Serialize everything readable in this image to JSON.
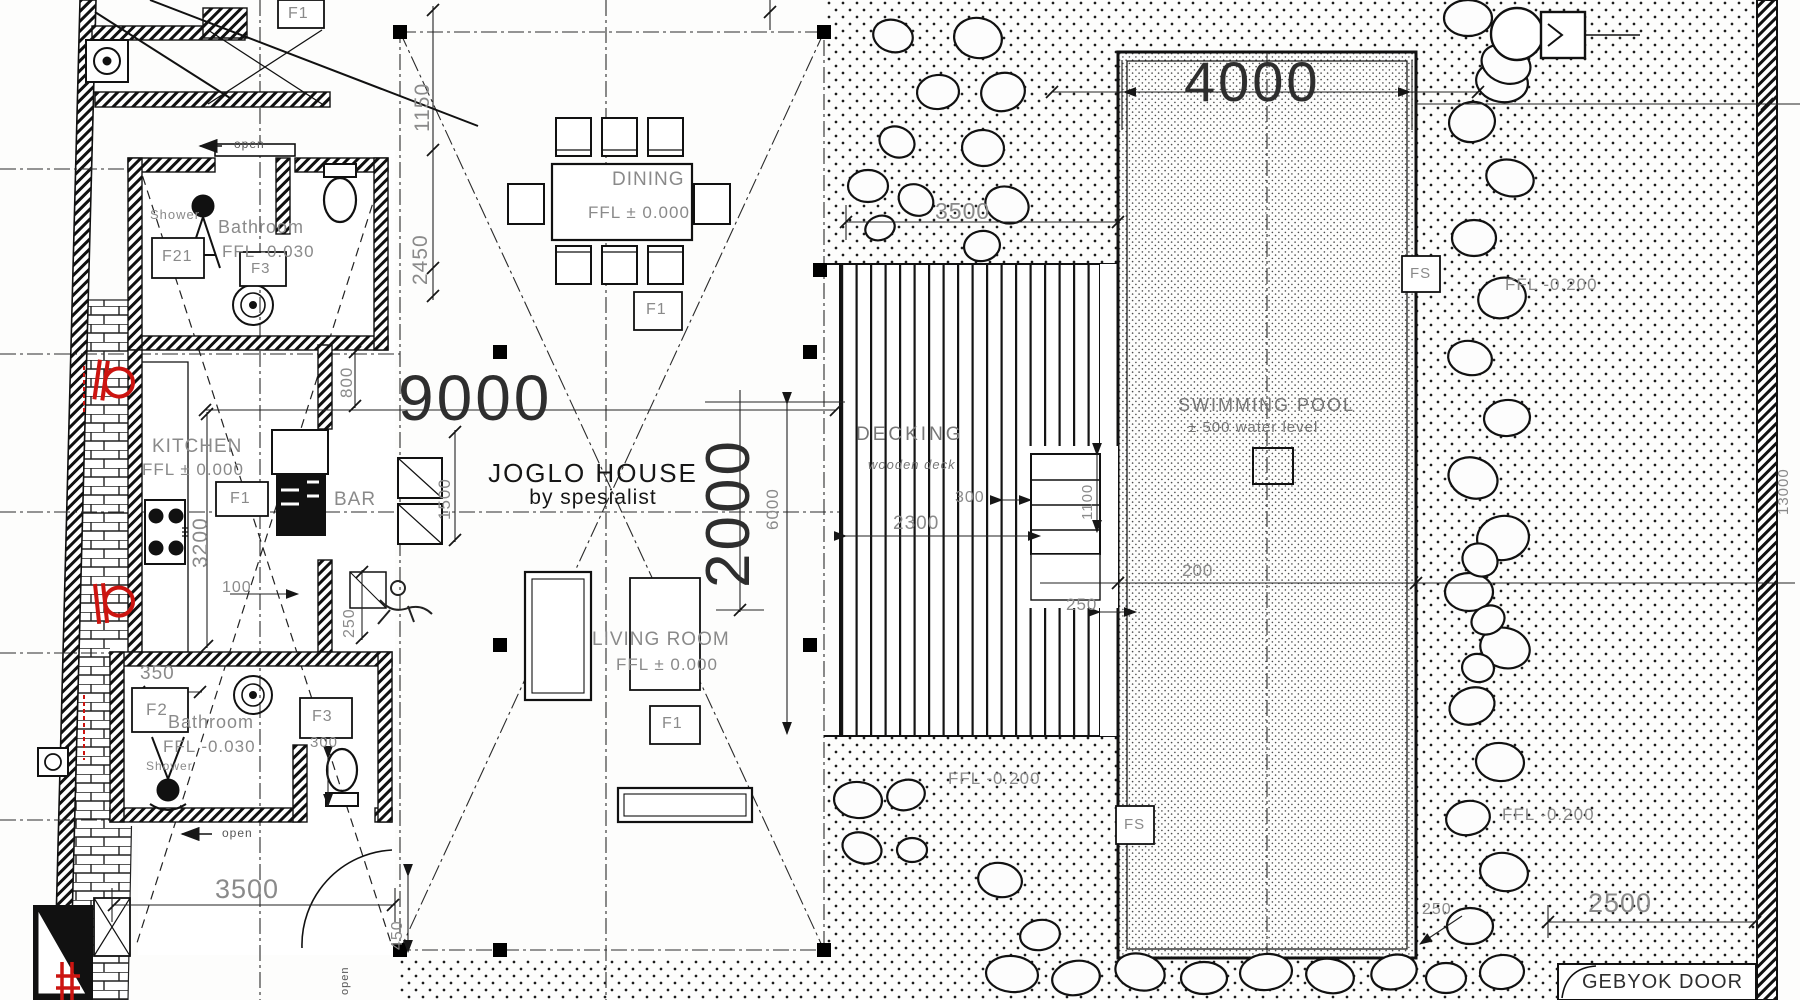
{
  "title": {
    "name": "JOGLO HOUSE",
    "byline": "by spesialist"
  },
  "rooms": {
    "dining": {
      "name": "DINING",
      "ffl": "FFL ± 0.000"
    },
    "kitchen": {
      "name": "KITCHEN",
      "ffl": "FFL ± 0.000"
    },
    "bar": {
      "name": "BAR"
    },
    "living": {
      "name": "LIVING ROOM",
      "ffl": "FFL ± 0.000"
    },
    "bathroom_top": {
      "name": "Bathroom",
      "ffl": "FFL -0.030",
      "shower": "Shower"
    },
    "bathroom_bottom": {
      "name": "Bathroom",
      "ffl": "FFL -0.030",
      "shower": "Shower"
    },
    "decking": {
      "name": "DECKING",
      "subtitle": "wooden deck"
    },
    "pool": {
      "name": "SWIMMING POOL",
      "subtitle": "± 500 water level"
    }
  },
  "outdoor": {
    "ffl_left": "FFL -0.200",
    "ffl_right_top": "FFL -0.200",
    "ffl_right_bottom": "FFL -0.200"
  },
  "dims": {
    "w9000": "9000",
    "h2000": "2000",
    "pool_w": "4000",
    "path_top": "3500",
    "bottom_left": "3500",
    "gebyok_w": "2500",
    "v2450": "2450",
    "v1150": "1150",
    "v800": "800",
    "v3200": "3200",
    "v1500": "1500",
    "h100": "100",
    "v250": "250",
    "h350": "350",
    "v450": "450",
    "deck_h": "6000",
    "deck_w": "2300",
    "step": "300",
    "step_len": "1100",
    "pool_edge": "250",
    "coping": "200",
    "pool_corner": "250",
    "site": "13000",
    "bath": "300"
  },
  "tags": {
    "f1": "F1",
    "f2": "F2",
    "f21": "F21",
    "f3": "F3",
    "fs": "FS"
  },
  "annotations": {
    "open": "open",
    "gebyok_door": "GEBYOK DOOR"
  },
  "colors": {
    "ink": "#161616",
    "gray_text": "#8a8a8a",
    "red": "#cc1410"
  }
}
